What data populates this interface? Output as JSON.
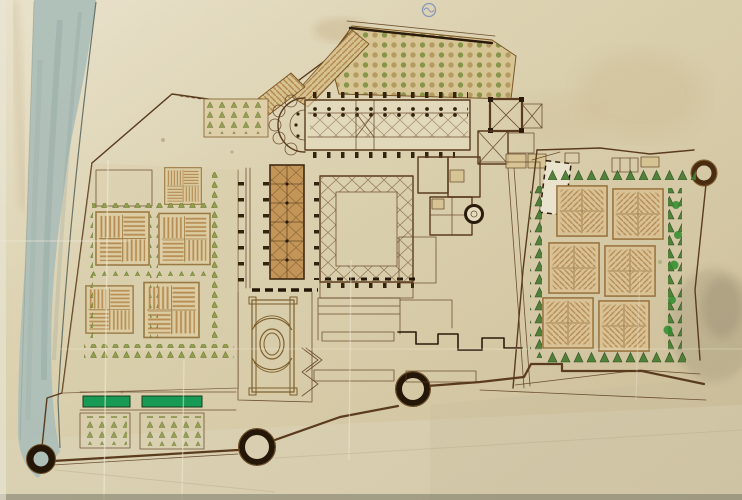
{
  "meta": {
    "description": "Hand-drawn bird's-eye plan of a walled monastic complex: abbey church, great cloister, formal parterre gardens, orchards, a river band on the left, round bastion towers on the perimeter wall, drawn in brown ink and wash on aged creased paper; a small blue stamp at top centre; no text visible."
  },
  "palette": {
    "paper": "#ddd2b0",
    "paper_light": "#e9e2cc",
    "paper_dark": "#cbbd96",
    "ink": "#5a3b1d",
    "ink_dark": "#2a1b0c",
    "hatch": "#b08347",
    "tan_wash": "#d6c291",
    "ochre_wash": "#c08e4e",
    "tree_olive": "#93a04b",
    "pine_green": "#4a7c33",
    "bright_green": "#169a54",
    "river": "#abbeb8",
    "river_edge": "#54615a",
    "stamp_blue": "#4a6fbe",
    "stain": "#9f9478"
  },
  "features": {
    "river": {
      "name": "river-band"
    },
    "stamp": {
      "name": "blue-ink-stamp"
    },
    "church": {
      "name": "abbey-church",
      "apse_chapels": 5
    },
    "cloister": {
      "name": "great-cloister"
    },
    "towers": {
      "count": 4
    },
    "gardens": [
      {
        "name": "left-parterre-garden",
        "hatched_beds": 5,
        "green_ponds": 2,
        "orchard_plots": 2
      },
      {
        "name": "right-parterre-garden",
        "hatched_beds": 6
      },
      {
        "name": "top-orchard",
        "tree_rows": "grid"
      },
      {
        "name": "oval-parterre-garden",
        "motif": "stepped border with central oval"
      }
    ]
  }
}
